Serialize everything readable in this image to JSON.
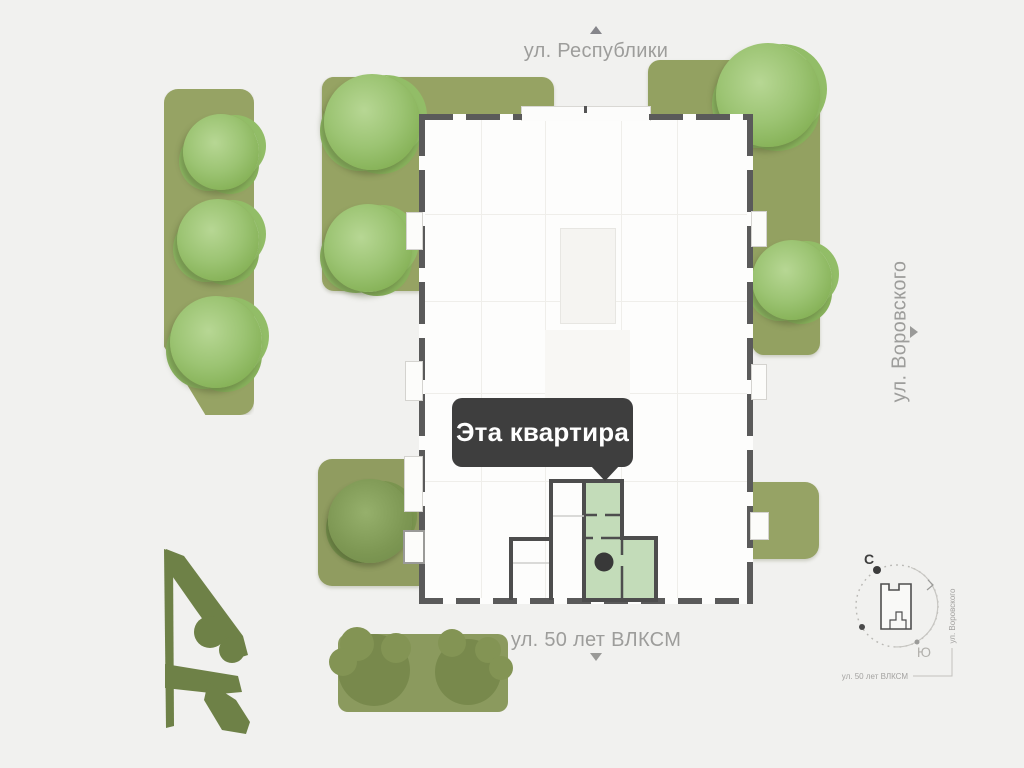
{
  "site_plan": {
    "streets": {
      "top": {
        "label": "ул. Республики"
      },
      "right": {
        "label": "ул. Воровского"
      },
      "bottom": {
        "label": "ул. 50 лет ВЛКСМ"
      }
    },
    "tooltip": {
      "label": "Эта квартира"
    },
    "compass": {
      "north_label": "С",
      "south_label": "Ю",
      "street_right_label": "ул. Воровского",
      "street_bottom_label": "ул. 50 лет ВЛКСМ"
    },
    "colors": {
      "background": "#f1f1ef",
      "lawn_green": "#96a364",
      "tree_green": "#9cc472",
      "bush_green": "#6e8147",
      "building_wall_gray": "#5a5a5a",
      "apartment_wall_gray": "#4d4d4d",
      "apartment_highlight_green": "#c3dcb9",
      "tooltip_background": "#3e3e3e",
      "tooltip_text": "#ffffff",
      "street_label_gray": "#9d9d9b"
    }
  }
}
